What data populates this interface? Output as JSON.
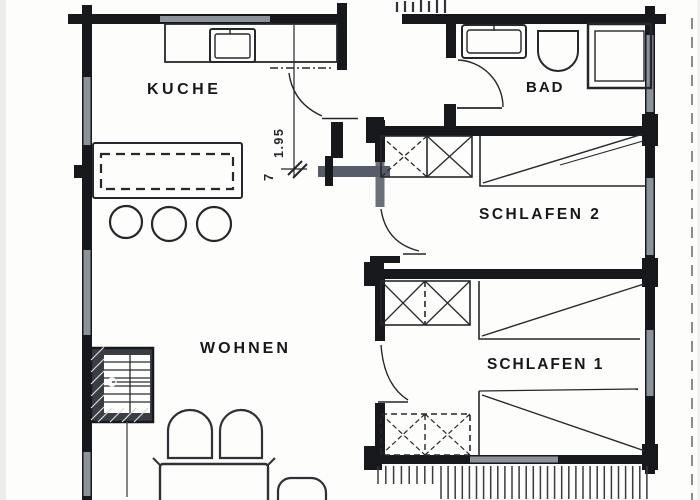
{
  "document": {
    "kind": "apartment floor plan (scanned drawing)"
  },
  "rooms": {
    "kueche": {
      "label": "KUCHE"
    },
    "bad": {
      "label": "BAD"
    },
    "schlafen2": {
      "label": "SCHLAFEN 2"
    },
    "schlafen1": {
      "label": "SCHLAFEN 1"
    },
    "wohnen": {
      "label": "WOHNEN"
    }
  },
  "annotations": {
    "door_dimension_vertical": "1.95",
    "door_dimension_lower": "7"
  },
  "palette": {
    "wall": "#17181c",
    "window_glass": "#8d939b",
    "partition_gray": "#565d68",
    "line": "#26272c",
    "paper": "#fdfdfc"
  },
  "symbols": [
    "stairs-symbol",
    "bar-stool-symbol",
    "sideboard-symbol",
    "kitchen-counter-symbol",
    "sink-symbol",
    "toilet-symbol",
    "shower-symbol",
    "wardrobe-symbol",
    "bed-symbol",
    "door-swing-symbol",
    "window-symbol",
    "balcony-decking-symbol",
    "chair-symbol",
    "table-symbol",
    "roof-overhang-dashed-line"
  ]
}
